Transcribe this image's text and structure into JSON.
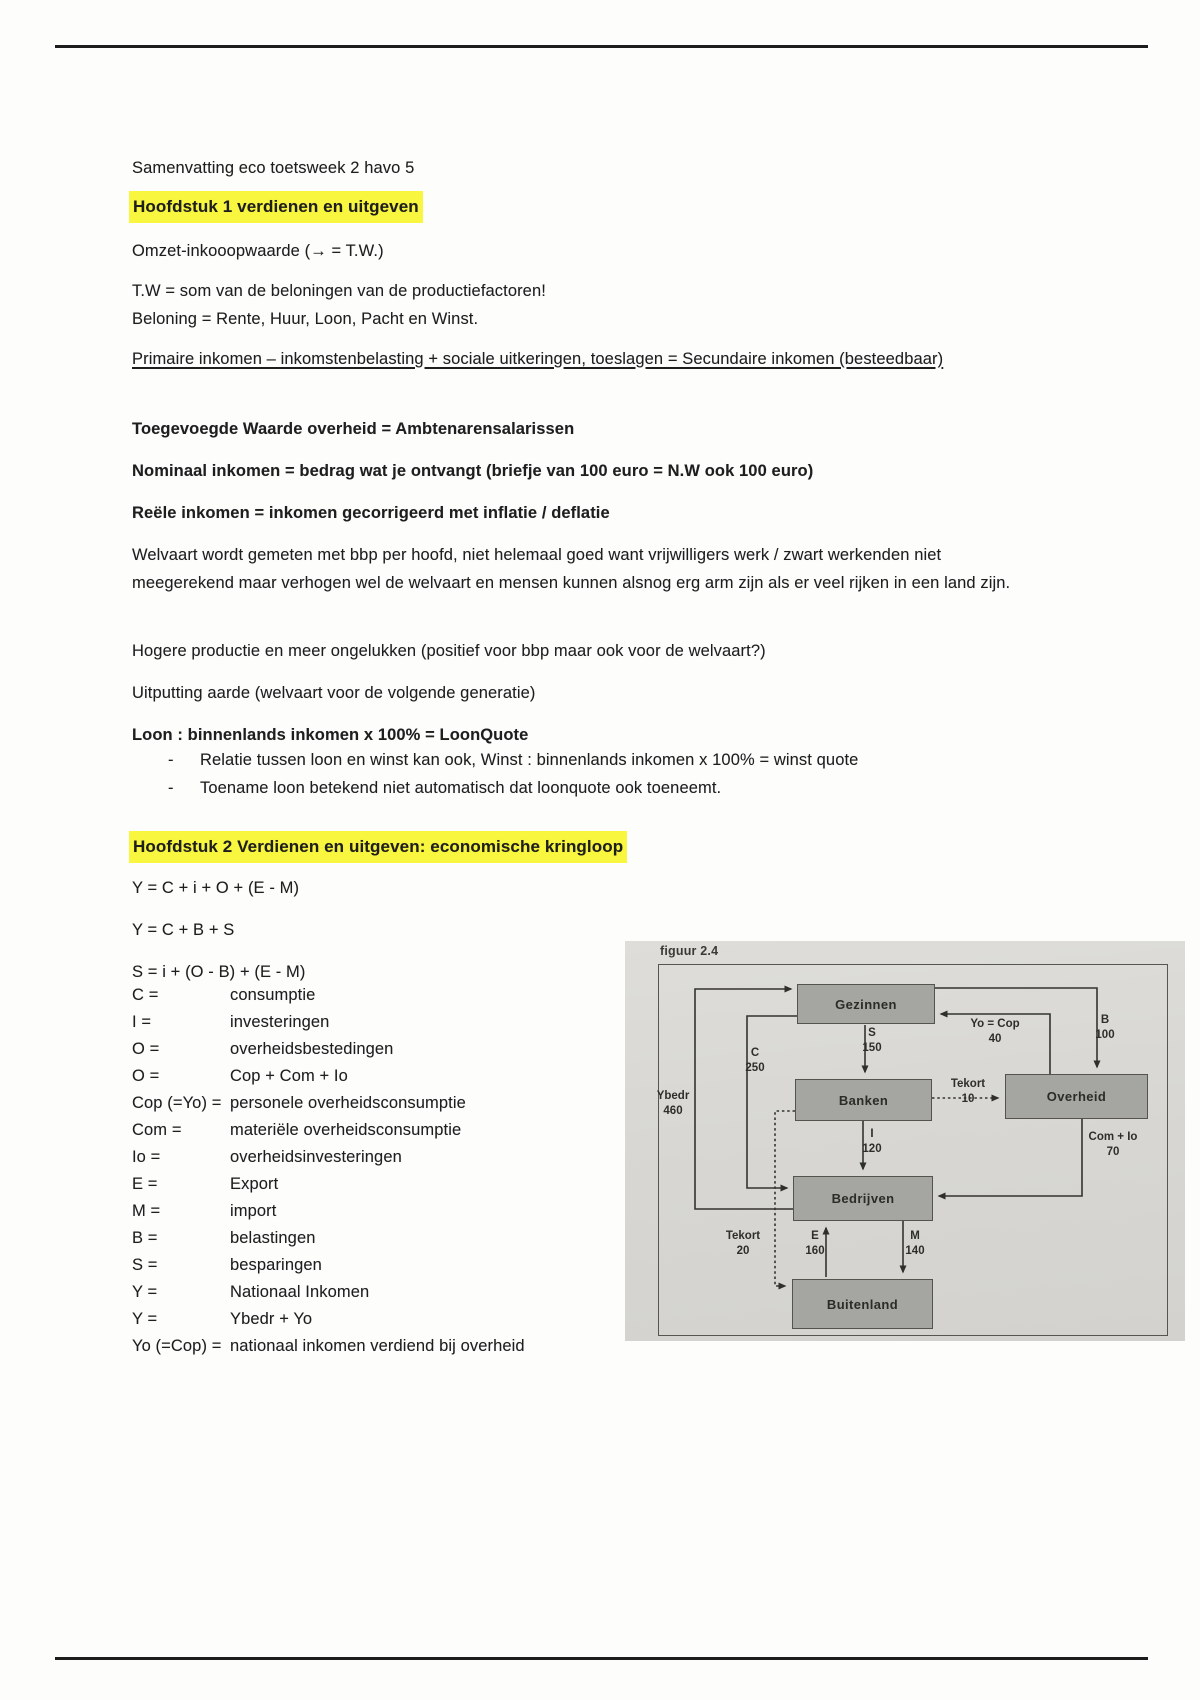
{
  "colors": {
    "highlight_yellow": "#f8f63e",
    "photo_background": "#d8d7d3",
    "diagram_box_fill": "#a5a5a2",
    "diagram_box_border": "#54544c",
    "diagram_line": "#33332f"
  },
  "doc": {
    "title": "Samenvatting eco toetsweek 2 havo 5",
    "chapter1": {
      "heading": "Hoofdstuk 1 verdienen en uitgeven",
      "paragraphs": {
        "omzet": "Omzet-inkooopwaarde (→ = T.W.)",
        "tw": "T.W = som van de beloningen van de productiefactoren!\nBeloning = Rente, Huur, Loon, Pacht en Winst.",
        "primaire": "Primaire inkomen – inkomstenbelasting + sociale uitkeringen, toeslagen = Secundaire inkomen (besteedbaar)",
        "toegevoegde": "Toegevoegde Waarde overheid = Ambtenarensalarissen",
        "nominaal": "Nominaal inkomen = bedrag wat je ontvangt (briefje van 100 euro = N.W ook 100 euro)",
        "reele": "Reële inkomen = inkomen gecorrigeerd met inflatie / deflatie",
        "welvaart": "Welvaart wordt gemeten met bbp per hoofd, niet helemaal goed want vrijwilligers werk / zwart werkenden niet meegerekend maar verhogen wel de welvaart en mensen kunnen alsnog erg arm zijn als er veel rijken in een land zijn.",
        "hogere": "Hogere productie en meer ongelukken (positief voor bbp maar ook voor de welvaart?)",
        "uitputting": "Uitputting aarde (welvaart voor de volgende generatie)",
        "loon": "Loon : binnenlands inkomen x 100% = LoonQuote"
      },
      "bullet_marker": "-",
      "bullets": [
        "Relatie tussen loon en winst kan ook, Winst : binnenlands inkomen x 100% = winst quote",
        "Toename loon betekend niet automatisch dat loonquote ook toeneemt."
      ]
    },
    "chapter2": {
      "heading": "Hoofdstuk 2 Verdienen en uitgeven: economische kringloop",
      "formulas": {
        "f1": "Y = C + i + O + (E - M)",
        "f2": "Y = C + B + S",
        "f3": "S = i + (O - B) + (E - M)"
      },
      "definitions": [
        {
          "term": "C =",
          "desc": "consumptie"
        },
        {
          "term": "I =",
          "desc": "investeringen"
        },
        {
          "term": "O =",
          "desc": "overheidsbestedingen"
        },
        {
          "term": "O =",
          "desc": "Cop + Com + Io"
        },
        {
          "term": "Cop (=Yo) =",
          "desc": "personele overheidsconsumptie"
        },
        {
          "term": "Com =",
          "desc": "materiële overheidsconsumptie"
        },
        {
          "term": "Io =",
          "desc": "overheidsinvesteringen"
        },
        {
          "term": "E =",
          "desc": "Export"
        },
        {
          "term": "M =",
          "desc": "import"
        },
        {
          "term": "B =",
          "desc": "belastingen"
        },
        {
          "term": "S =",
          "desc": "besparingen"
        },
        {
          "term": "Y =",
          "desc": "Nationaal Inkomen"
        },
        {
          "term": "Y =",
          "desc": "Ybedr + Yo"
        },
        {
          "term": "Yo (=Cop) =",
          "desc": "nationaal inkomen verdiend bij overheid"
        }
      ]
    }
  },
  "figure": {
    "caption": "figuur 2.4",
    "nodes": [
      {
        "id": "gezinnen",
        "label": "Gezinnen"
      },
      {
        "id": "banken",
        "label": "Banken"
      },
      {
        "id": "overheid",
        "label": "Overheid"
      },
      {
        "id": "bedrijven",
        "label": "Bedrijven"
      },
      {
        "id": "buitenland",
        "label": "Buitenland"
      }
    ],
    "flows": [
      {
        "id": "ybedr",
        "label": "Ybedr",
        "value": "460",
        "from": "Bedrijven",
        "to": "Gezinnen"
      },
      {
        "id": "c",
        "label": "C",
        "value": "250",
        "from": "Gezinnen",
        "to": "Bedrijven"
      },
      {
        "id": "s",
        "label": "S",
        "value": "150",
        "from": "Gezinnen",
        "to": "Banken"
      },
      {
        "id": "i",
        "label": "I",
        "value": "120",
        "from": "Banken",
        "to": "Bedrijven"
      },
      {
        "id": "b",
        "label": "B",
        "value": "100",
        "from": "Gezinnen",
        "to": "Overheid"
      },
      {
        "id": "yocop",
        "label": "Yo = Cop",
        "value": "40",
        "from": "Overheid",
        "to": "Gezinnen"
      },
      {
        "id": "tekort10",
        "label": "Tekort",
        "value": "10",
        "from": "Banken",
        "to": "Overheid"
      },
      {
        "id": "com_io",
        "label": "Com + Io",
        "value": "70",
        "from": "Overheid",
        "to": "Bedrijven"
      },
      {
        "id": "tekort20",
        "label": "Tekort",
        "value": "20",
        "from": "Banken",
        "to": "Buitenland"
      },
      {
        "id": "e",
        "label": "E",
        "value": "160",
        "from": "Buitenland",
        "to": "Bedrijven"
      },
      {
        "id": "m",
        "label": "M",
        "value": "140",
        "from": "Bedrijven",
        "to": "Buitenland"
      }
    ]
  }
}
